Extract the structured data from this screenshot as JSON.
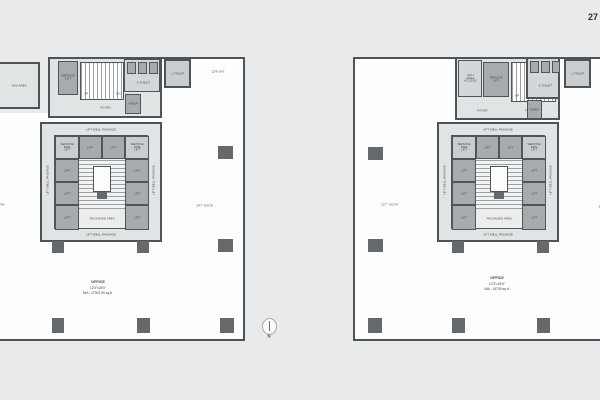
{
  "page": {
    "corner_number": "27",
    "compass_label": "N"
  },
  "labels": {
    "lift": "LIFT",
    "service_fire_lift": "SERVICE FIRE LIFT",
    "service_lift": "SERVICE LIFT",
    "packaged_area": "PACKAGED AREA",
    "lift_well_passage": "LIFT WELL PASSAGE",
    "foyer": "FOYER",
    "riser": "RISER",
    "toilet_a": "A.TOILET",
    "toilet_l": "L.TOILET",
    "up": "UP",
    "dn": "DN",
    "ahu_area": "AHU AREA",
    "ahu_access": "AHU AREA ACCESS"
  },
  "plans": {
    "left": {
      "dim_top_right": "22'9\"x9'0\"",
      "dim_right": "34'7\" S/O\"W",
      "dim_left_fragment": "0\"W",
      "caption": {
        "title": "OFFICE",
        "dims": "12'3\"x24'0\"",
        "area": "NIA : 17302.99 sq.ft."
      }
    },
    "right": {
      "dim_left": "22'7\" S/O\"W",
      "dim_right_fragment": "34'7\"",
      "caption": {
        "title": "OFFICE",
        "dims": "12'3\"x24'6\"",
        "area": "NIA : 16730 sq.ft."
      }
    }
  }
}
